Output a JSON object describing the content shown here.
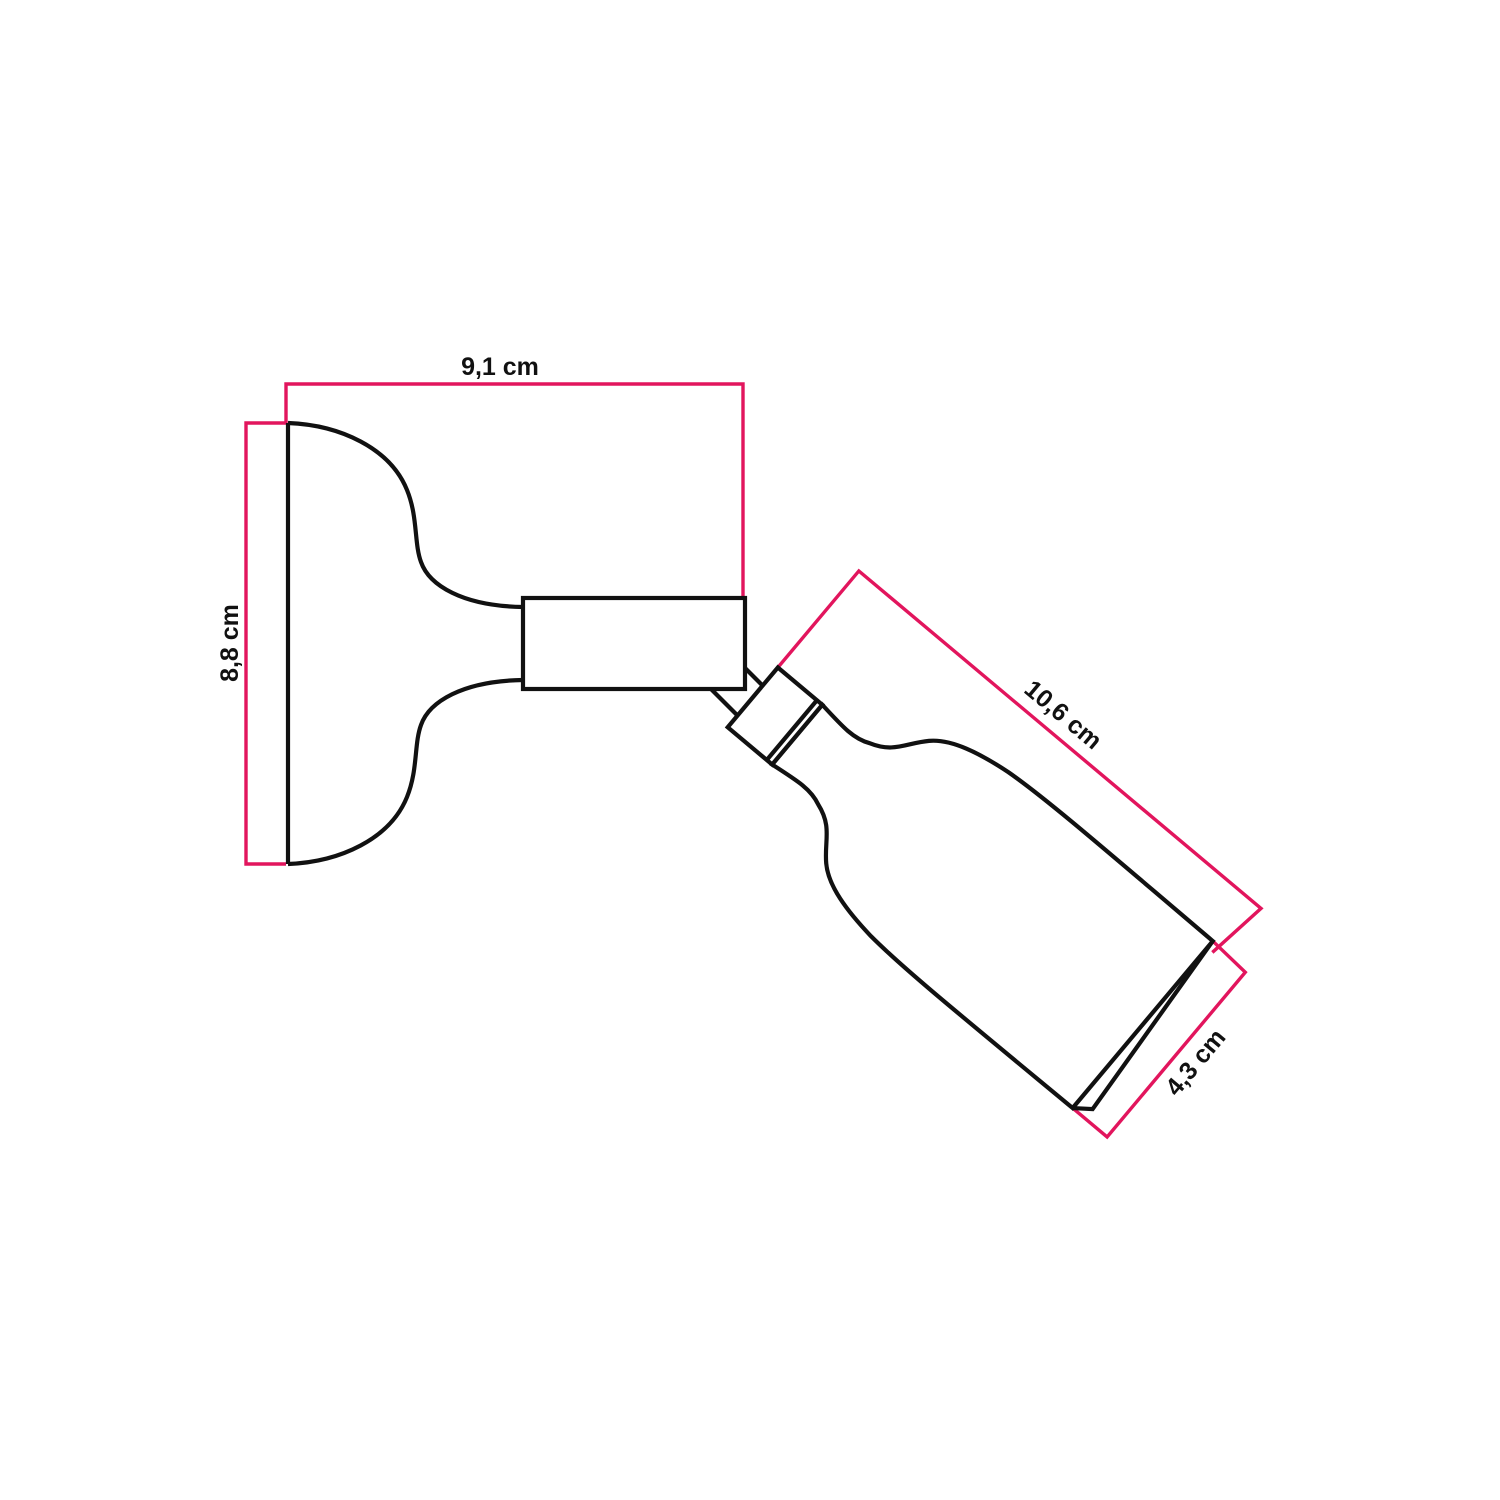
{
  "colors": {
    "pink": "#e2155d",
    "black": "#111111",
    "white": "#ffffff",
    "background": "#ffffff"
  },
  "diagram": {
    "type": "product-dimension-drawing",
    "subject": "adjustable wall-mounted spotlight with flared round base and tilted conical lamp body",
    "dimensions": [
      {
        "name": "base-projection-width",
        "label": "9,1 cm"
      },
      {
        "name": "base-plate-height",
        "label": "8,8 cm"
      },
      {
        "name": "lamp-body-length",
        "label": "10,6 cm"
      },
      {
        "name": "lamp-face-diameter",
        "label": "4,3 cm"
      }
    ]
  }
}
